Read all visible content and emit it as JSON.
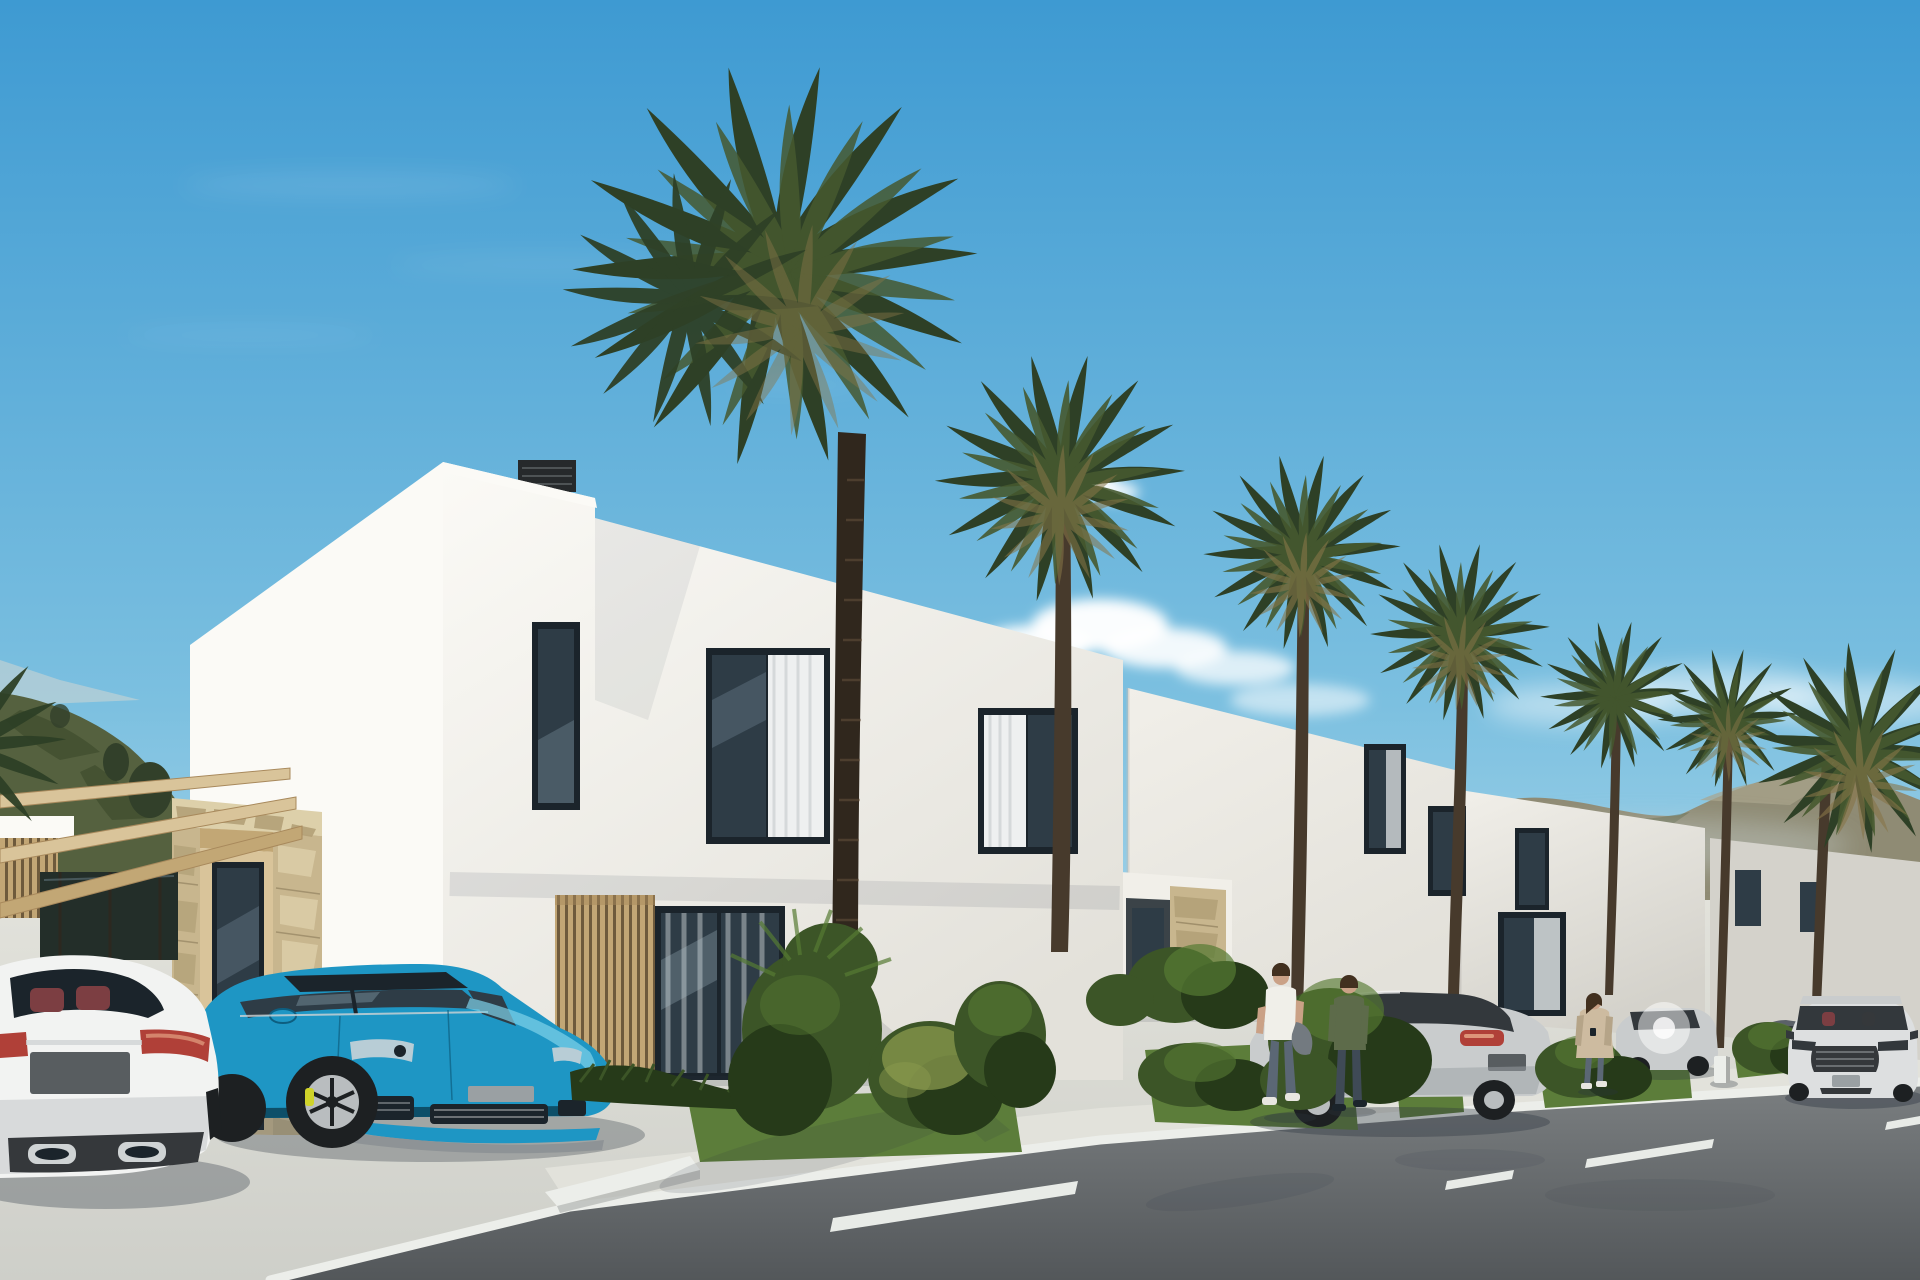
{
  "scene": {
    "title": "New-build white villas street rendering",
    "type": "3D architectural exterior visualization",
    "time_of_day": "sunny day, clear blue sky",
    "sky": {
      "clouds": [
        "small puff above second villa",
        "cumulus bank behind first villa roofline",
        "hazy band over right mountains",
        "faint streaks upper left"
      ]
    },
    "terrain": {
      "left": "green scrub hill with small trees",
      "right": "distant brown-olive mountain ridge in haze"
    },
    "houses": [
      {
        "id": 1,
        "position": "foreground left",
        "features": [
          "two-storey white cube",
          "taller stair volume with black roof vent",
          "stone-clad entrance portal",
          "wood pergola carport",
          "vertical wood louver screen",
          "glass slider with curtains",
          "three dark upper windows"
        ]
      },
      {
        "id": 2,
        "position": "middle",
        "features": [
          "stepped-down white facade",
          "stone entrance portal",
          "wood louver panel",
          "upper window with curtain",
          "rooftop solar panel"
        ]
      },
      {
        "id": 3,
        "position": "middle right",
        "features": [
          "white facade",
          "two narrow dark windows",
          "wood louver panel",
          "ground glass window"
        ]
      },
      {
        "id": 4,
        "position": "far right",
        "features": [
          "white facade receding",
          "small dark windows"
        ]
      }
    ],
    "palm_trees": {
      "count": 8,
      "largest": "tall fan palm in front of first villa"
    },
    "vehicles": [
      {
        "id": "white-sedan",
        "description": "white luxury sedan, rear view, red leather seats visible",
        "state": "parked under pergola"
      },
      {
        "id": "blue-sports-wagon",
        "description": "metallic azure sports wagon, front three-quarter view, yellow brake calipers",
        "state": "parked on driveway"
      },
      {
        "id": "silver-sedan",
        "description": "silver sedan, rear three-quarter view, red taillight",
        "state": "parked at second driveway"
      },
      {
        "id": "silver-hatchback",
        "description": "small silver car with bright sun glare",
        "state": "parked further down"
      },
      {
        "id": "dark-car",
        "description": "dark gray car behind shrubs",
        "state": "parked"
      },
      {
        "id": "silver-driving-car",
        "description": "silver sport sedan, honeycomb grille, two occupants",
        "state": "driving toward viewer"
      }
    ],
    "people": [
      {
        "id": "man-white-tshirt",
        "description": "man in white t-shirt and jeans carrying a gray jacket, walking away"
      },
      {
        "id": "person-green-top",
        "description": "person in green long-sleeve top and dark jeans, walking away"
      },
      {
        "id": "woman-beige-coat",
        "description": "woman in long beige coat checking phone on sidewalk"
      }
    ],
    "street": {
      "surface": "asphalt",
      "markings": "dashed white center line",
      "curb": "white painted curb",
      "sidewalk": "light concrete with lawn strips and shrub beds",
      "bollard": "small white marker post"
    }
  },
  "colors": {
    "sky_top": "#3e9ad2",
    "sky_mid": "#7cc0e0",
    "sky_low": "#d3ebf3",
    "cloud": "#ffffff",
    "hill": "#55613f",
    "hill_dark": "#414f2f",
    "hill_tree": "#32402a",
    "mountain": "#8f8b74",
    "mountain_light": "#a9a58d",
    "mountain_haze": "#c9d3d2",
    "wall_bright": "#fbfaf6",
    "wall_light": "#f1efe9",
    "wall_mid": "#e3e1da",
    "wall_shade": "#d4d2cb",
    "wall_dark": "#bfbdb7",
    "roof_vent": "#26292b",
    "glass": "#2e3c46",
    "glass_light": "#7e96a4",
    "glass_refl": "#b8cdd6",
    "frame": "#1b242b",
    "curtain": "#eef0f0",
    "curtain_shade": "#d5d9da",
    "stone": "#c8b68e",
    "stone_light": "#ddd0aa",
    "stone_mid": "#b2a077",
    "stone_dark": "#93825d",
    "mortar": "#857454",
    "wood": "#d9c49a",
    "wood_mid": "#c2a775",
    "wood_dark": "#a8895c",
    "louver": "#c2a675",
    "louver_gap": "#6e5a3c",
    "trunk": "#473a2c",
    "trunk_light": "#6a563f",
    "trunk_dark": "#30271d",
    "frond_dark": "#2e4026",
    "frond_mid": "#46592f",
    "frond_light": "#5d7038",
    "frond_dry": "#877648",
    "bush": "#3c5527",
    "bush_light": "#567a33",
    "bush_dark": "#263a19",
    "bush_yellow": "#8a9a4e",
    "grass": "#5c7d3a",
    "grass_light": "#79a04b",
    "concrete": "#cecfc9",
    "concrete_light": "#e2e2db",
    "concrete_shadow": "#a9aba8",
    "road_far": "#7b7f81",
    "road_near": "#53575a",
    "curb": "#eceeea",
    "dash": "#e8ebe7",
    "shadow": "#2c3440",
    "car_white": "#f2f3f2",
    "car_white_mid": "#dddfe0",
    "car_white_dark": "#b9bcbe",
    "seat_red": "#7c3e42",
    "tail_red": "#b04038",
    "tail_amber": "#dd9579",
    "chrome": "#cfd3d4",
    "plate_dark": "#585d60",
    "plate_gray": "#9aa0a3",
    "bumper_dark": "#35383b",
    "gray_trim": "#8e9396",
    "car_blue": "#1e96c4",
    "car_blue_light": "#7fd2ea",
    "car_blue_dark": "#0d5e80",
    "car_blue_deep": "#093d52",
    "wheel_dark": "#1d2022",
    "rim": "#b9bdbf",
    "caliper": "#cfd32a",
    "car_silver": "#c9cccd",
    "car_silver_dark": "#9aa0a3",
    "car_glass": "#33383c",
    "car_dark": "#5b6168",
    "skin": "#caa186",
    "hair": "#42301f",
    "shirt_white": "#f0efe9",
    "jeans": "#5b6775",
    "jeans_dark": "#3f4a56",
    "top_green": "#5d6b4a",
    "coat": "#cdbba0",
    "coat_shade": "#b5a488",
    "jacket_gray": "#737a80",
    "shoe": "#e8e6e0",
    "fence_dark": "#232e29"
  }
}
